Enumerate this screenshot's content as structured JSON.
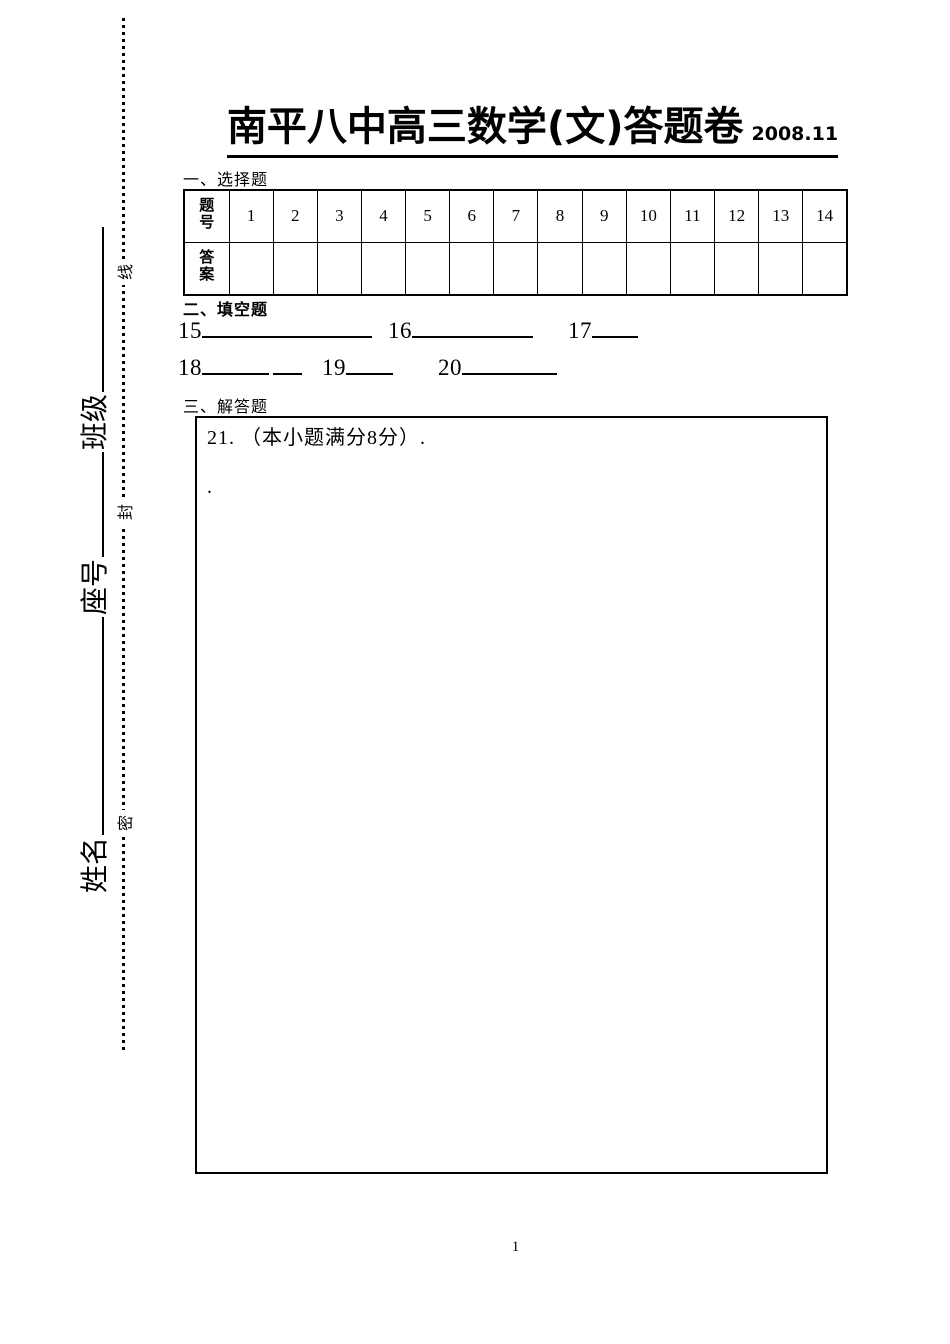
{
  "header": {
    "title": "南平八中高三数学(文)答题卷",
    "date": "2008.11"
  },
  "seal_line": {
    "top_char": "线",
    "middle_char": "封",
    "bottom_char": "密"
  },
  "student_info": {
    "name_label": "姓名",
    "seat_label": "座号",
    "class_label": "班级"
  },
  "choice_section": {
    "heading": "一、选择题",
    "question_header": "题号",
    "answer_header": "答案",
    "question_numbers": [
      "1",
      "2",
      "3",
      "4",
      "5",
      "6",
      "7",
      "8",
      "9",
      "10",
      "11",
      "12",
      "13",
      "14"
    ],
    "answers": [
      "",
      "",
      "",
      "",
      "",
      "",
      "",
      "",
      "",
      "",
      "",
      "",
      "",
      ""
    ]
  },
  "blank_section": {
    "heading": "二、填空题",
    "numbers": [
      "15",
      "16",
      "17",
      "18",
      "19",
      "20"
    ]
  },
  "solution_section": {
    "heading": "三、解答题",
    "question_line": "21. （本小题满分8分）.",
    "stray_dot": "."
  },
  "footer": {
    "page_number": "1"
  }
}
